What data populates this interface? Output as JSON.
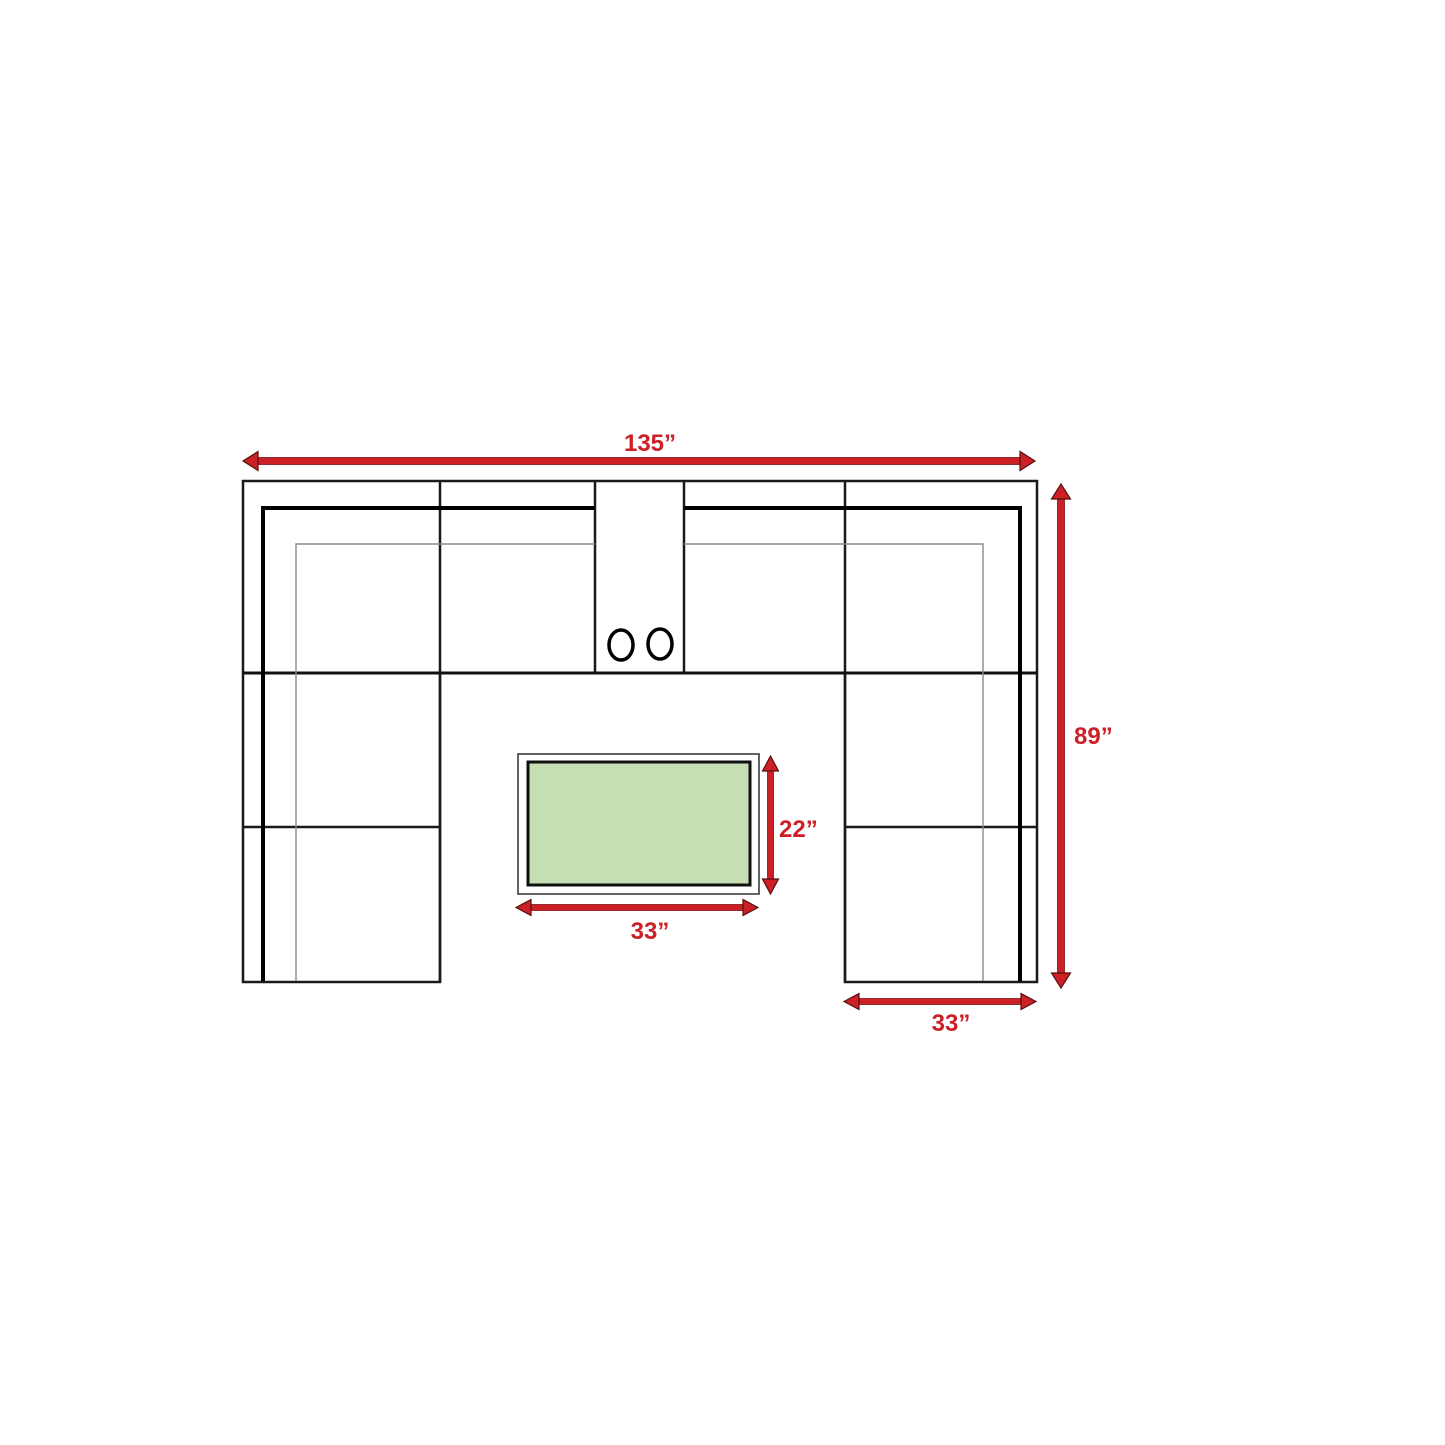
{
  "diagram": {
    "subject": "U-shaped sectional sofa floor plan with coffee table",
    "labels": {
      "overall_width": "135”",
      "overall_depth": "89”",
      "table_depth": "22”",
      "table_width": "33”",
      "arm_section_width": "33”"
    },
    "colors": {
      "dimension_red": "#cd2026",
      "table_green": "#c6deb4"
    }
  }
}
